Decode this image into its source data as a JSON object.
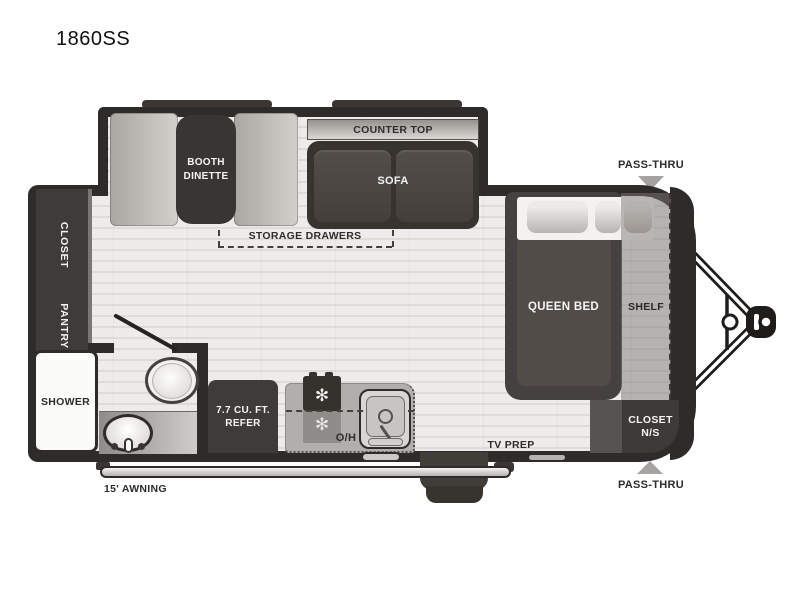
{
  "title": "1860SS",
  "slideout": {
    "booth_line1": "BOOTH",
    "booth_line2": "DINETTE",
    "counter_top": "COUNTER TOP",
    "sofa": "SOFA"
  },
  "living": {
    "storage_drawers": "STORAGE DRAWERS",
    "tv_prep": "TV PREP"
  },
  "left_side": {
    "closet": "CLOSET",
    "pantry": "PANTRY"
  },
  "bathroom": {
    "shower": "SHOWER"
  },
  "kitchen": {
    "refer_line1": "7.7 CU. FT.",
    "refer_line2": "REFER",
    "overhead": "O/H"
  },
  "bedroom": {
    "queen_bed": "QUEEN BED",
    "shelf": "SHELF",
    "closet_ns_line1": "CLOSET",
    "closet_ns_line2": "N/S"
  },
  "exterior": {
    "awning": "15' AWNING",
    "pass_thru_top": "PASS-THRU",
    "pass_thru_bottom": "PASS-THRU"
  },
  "icons": {
    "burner": "✻"
  },
  "colors": {
    "wall": "#2e2b2b",
    "dark_furniture": "#3f3b3a",
    "floor": "#e9e8e6",
    "bench": "#c5c1bd",
    "shelf_overlay": "#8d8886",
    "pass_thru_arrow": "#a5a3a1"
  }
}
